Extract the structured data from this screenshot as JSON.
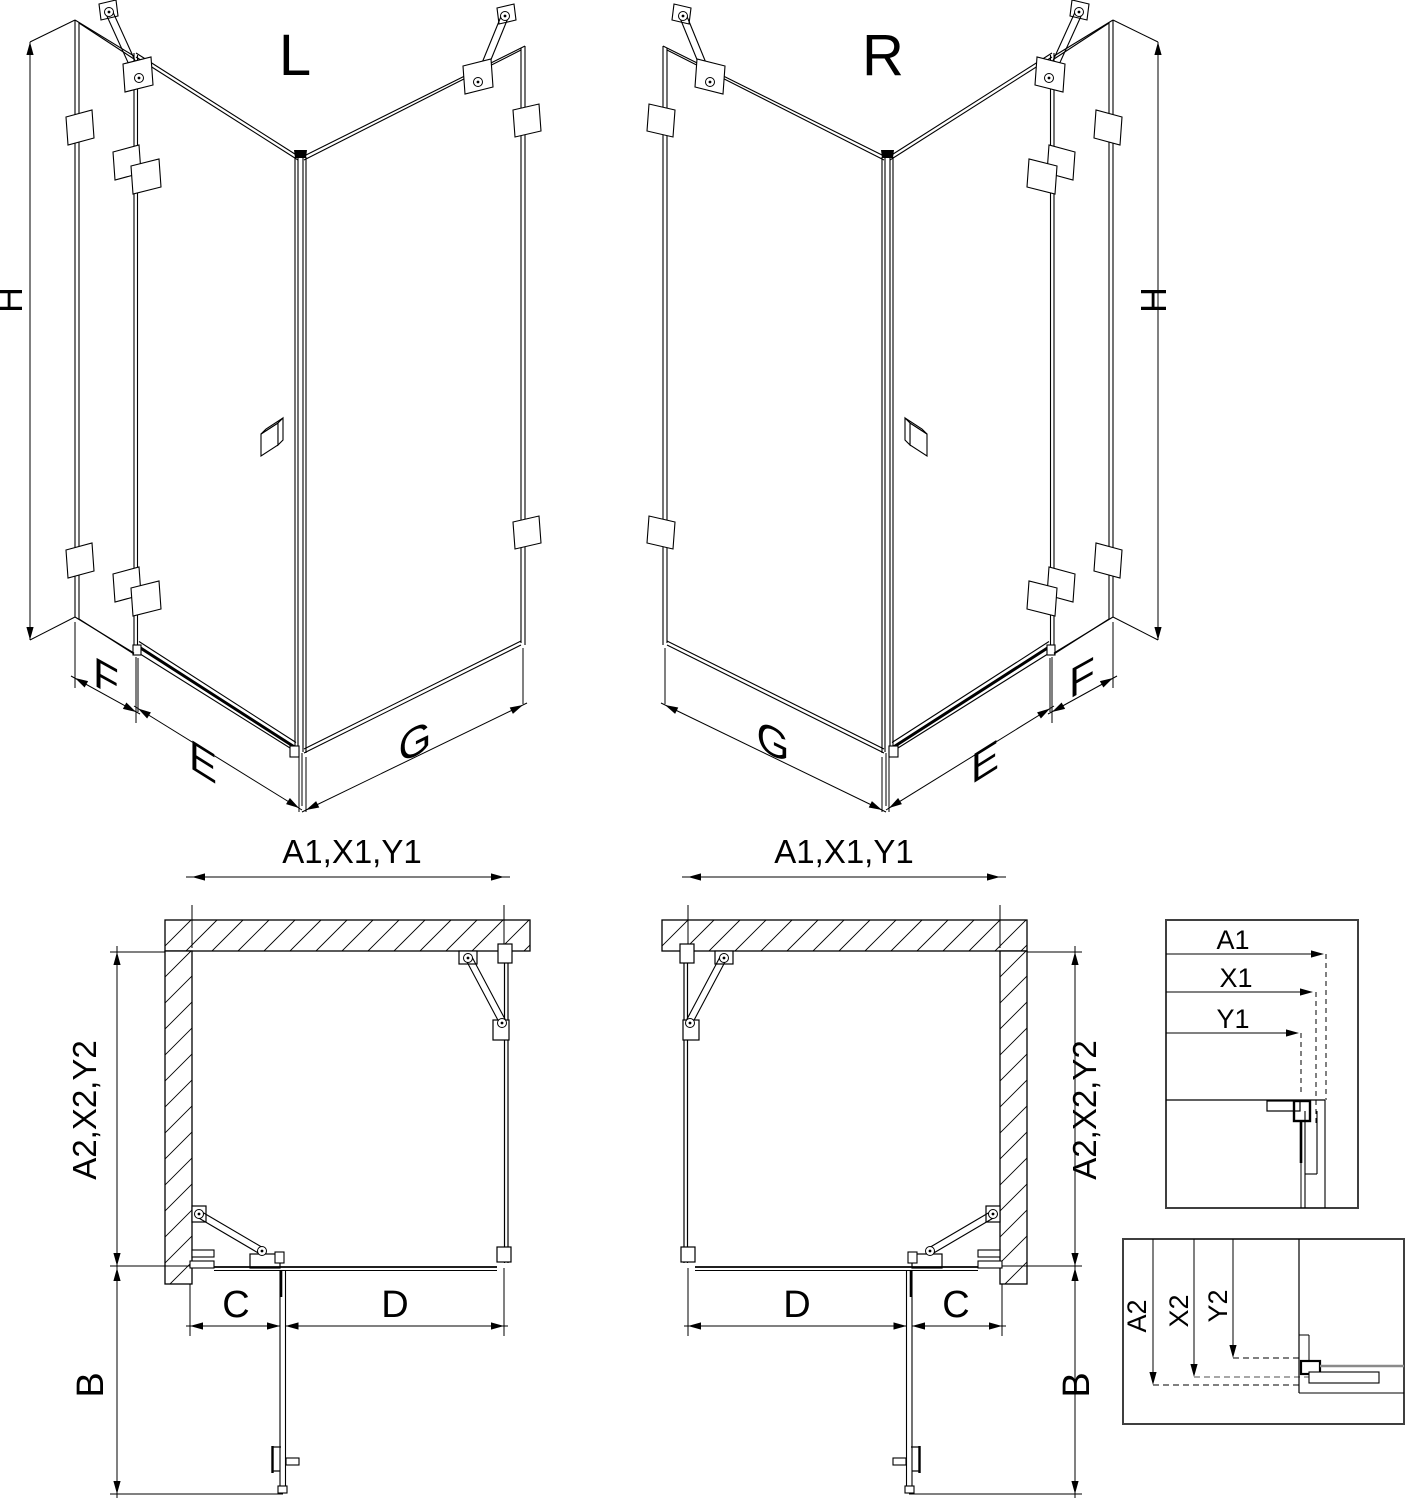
{
  "figure": {
    "left_variant": {
      "title": "L"
    },
    "right_variant": {
      "title": "R"
    },
    "dimensions": {
      "height": "H",
      "side_panel_width": "F",
      "door_width": "E",
      "return_panel_width": "G",
      "front_total_width": "A1,X1,Y1",
      "side_total_depth": "A2,X2,Y2",
      "door_segment": "C",
      "fixed_segment": "D",
      "door_opening_depth": "B"
    },
    "detail_top": {
      "rows": [
        "A1",
        "X1",
        "Y1"
      ]
    },
    "detail_bottom": {
      "rows": [
        "A2",
        "X2",
        "Y2"
      ]
    }
  }
}
